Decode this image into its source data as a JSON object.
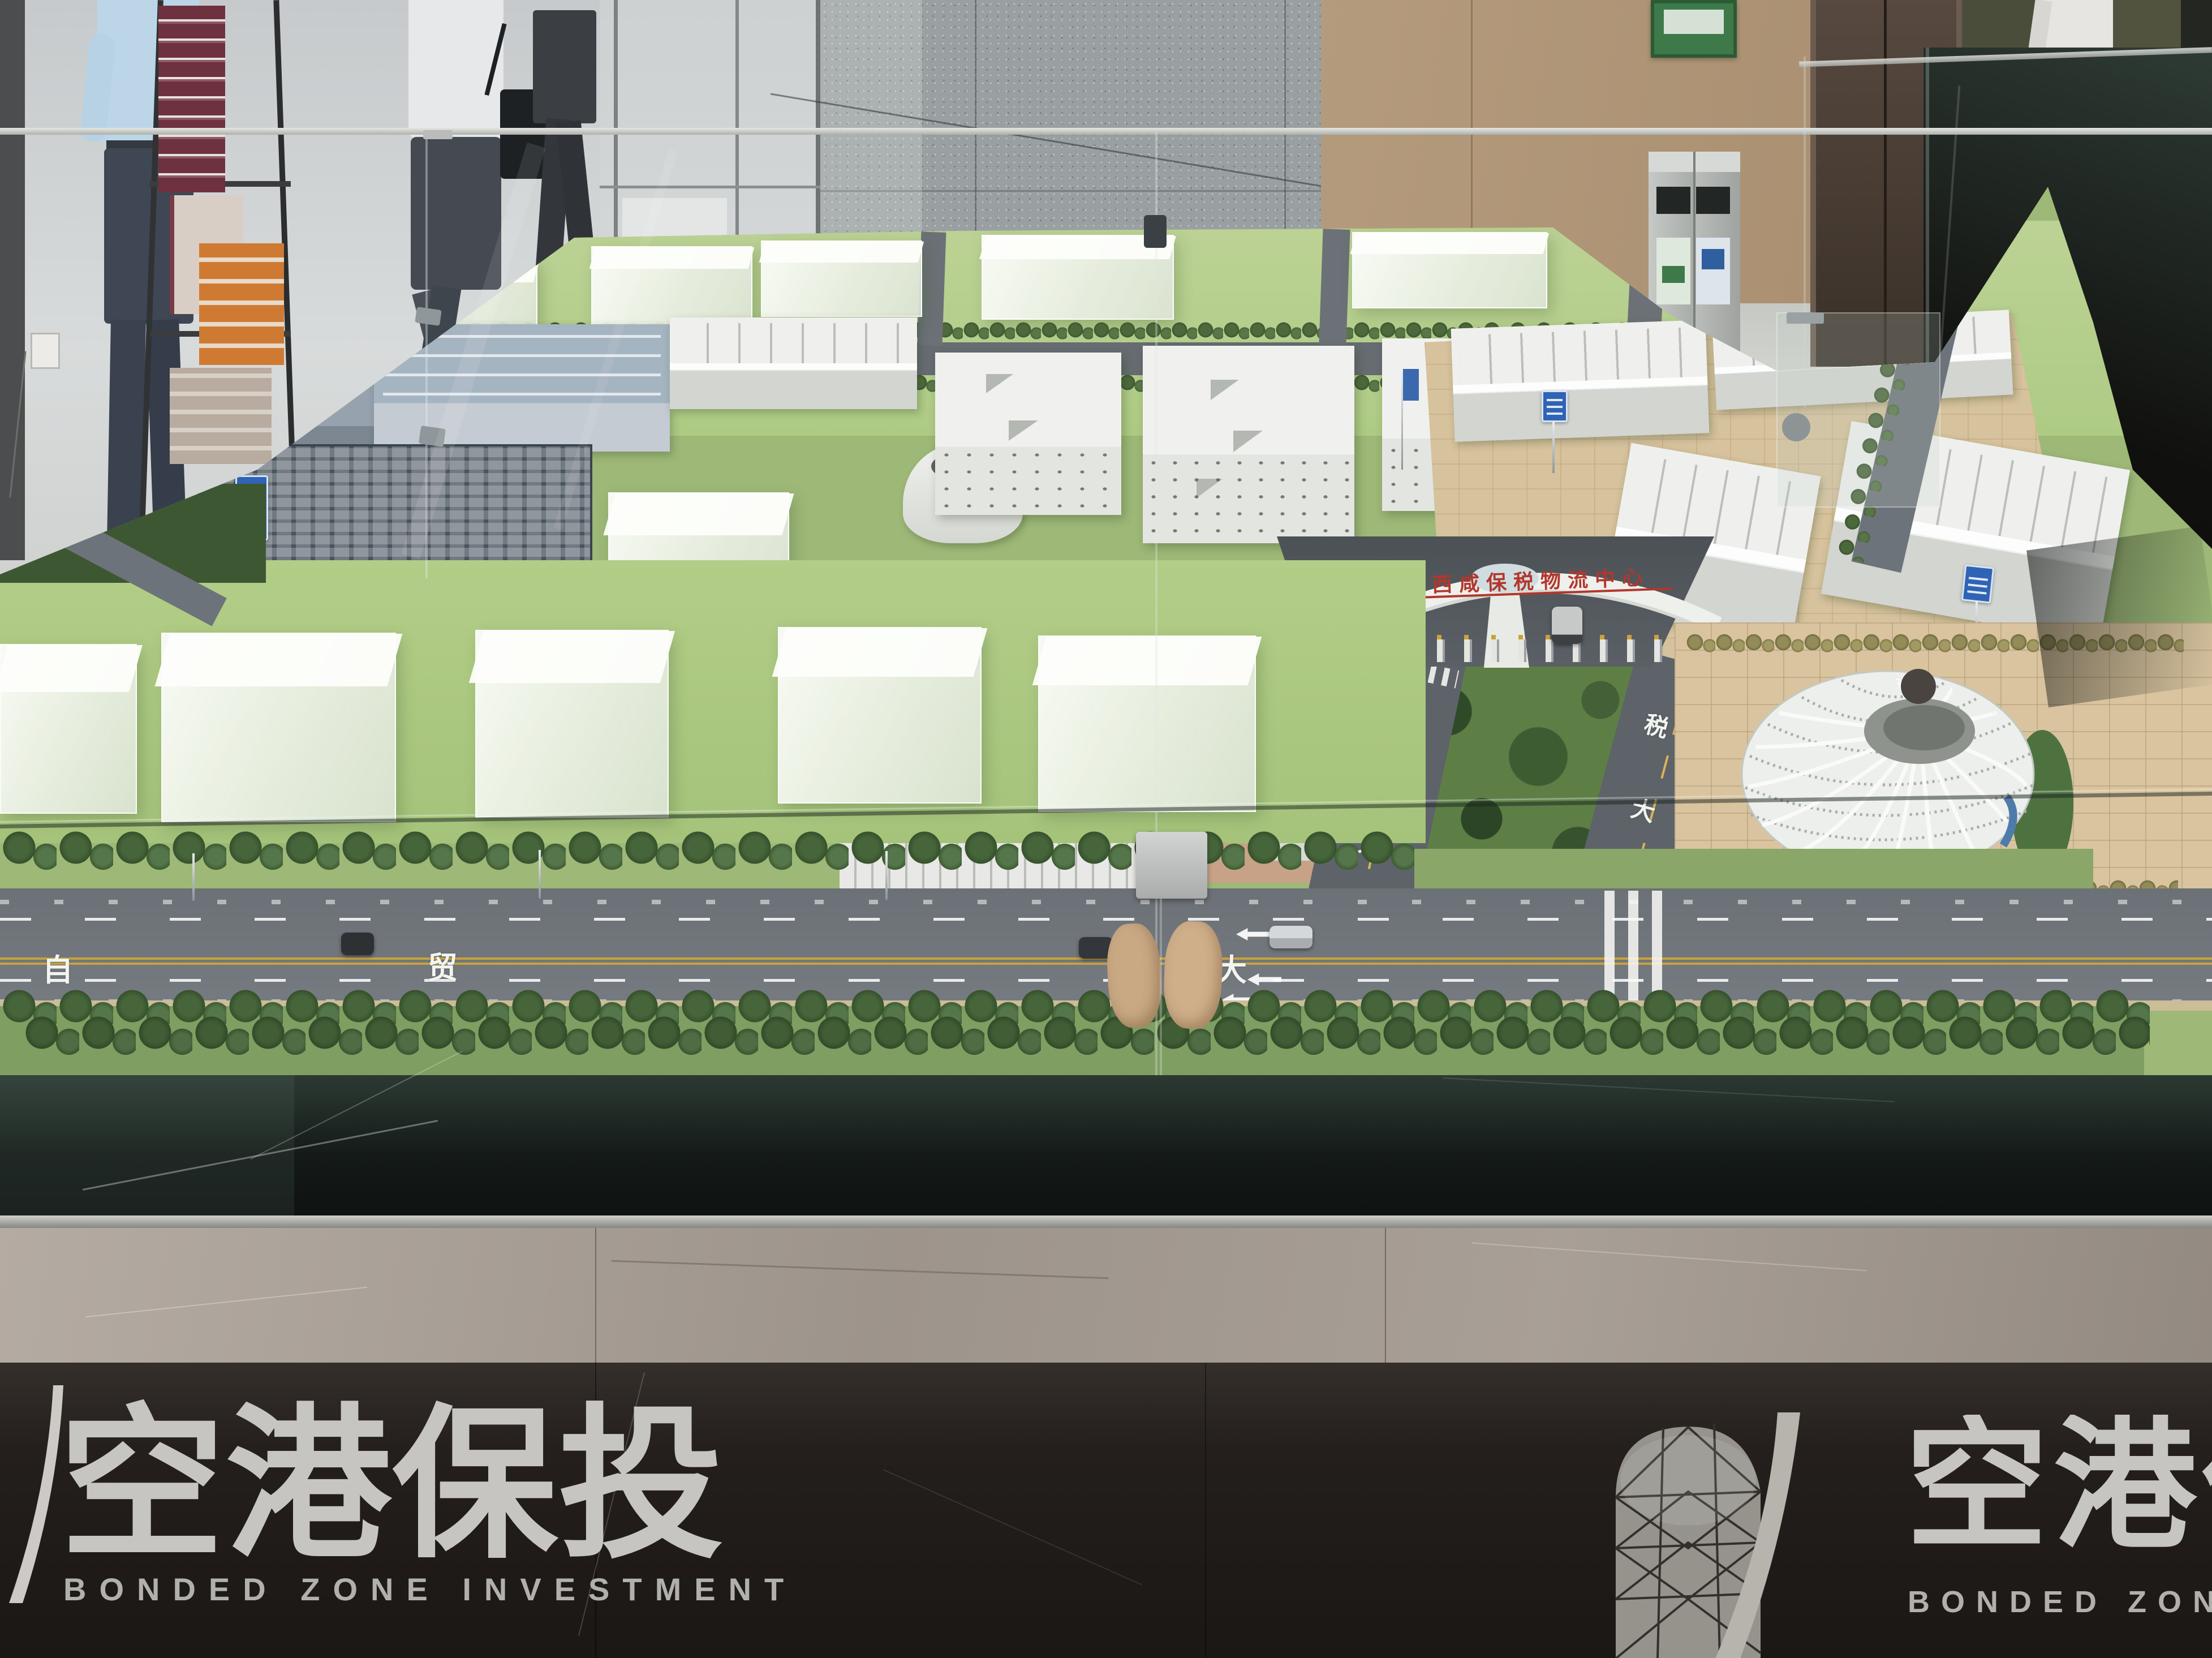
{
  "branding": {
    "left_logo": {
      "cn": "空港保投",
      "en": "BONDED ZONE INVESTMENT"
    },
    "right_logo": {
      "cn": "空港保",
      "en": "BONDED ZONE INVESTMENT"
    }
  },
  "model": {
    "gate_sign": "陕西西咸保税物流中心",
    "main_road_labels": [
      "自",
      "贸",
      "大"
    ],
    "bonded_road_left_labels": [
      "保",
      "税",
      "大",
      "道"
    ],
    "bonded_road_right_labels": [
      "税",
      "大",
      "道"
    ]
  },
  "colors": {
    "lawn": "#a9c57f",
    "road": "#70767b",
    "yellow_line": "#c9a23b",
    "sign_blue": "#2f63b5",
    "gate_text_red": "#b3362c",
    "base_dark": "#2b2724",
    "marble_band": "#a89f97",
    "logo_gray": "#c6c4c0"
  }
}
